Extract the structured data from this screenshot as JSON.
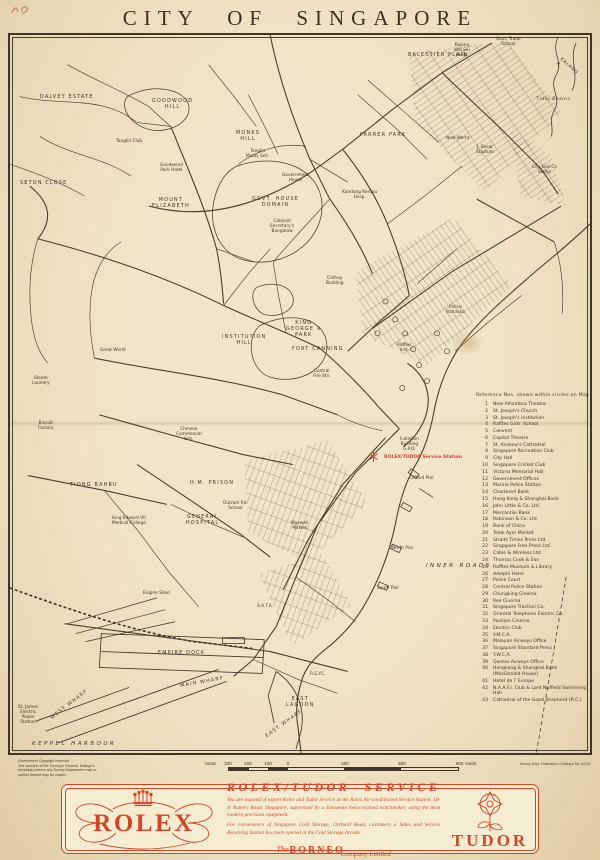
{
  "colors": {
    "accent": "#d64427",
    "ink": "#3f3526",
    "paper": "#e9dcba",
    "ad_bg": "#f5edd2"
  },
  "page": {
    "title": "CITY OF SINGAPORE"
  },
  "map": {
    "service_station_label": "ROLEX/TUDOR Service Station",
    "labels": [
      {
        "t": "DALVEY ESTATE",
        "x": 30,
        "y": 60,
        "cls": "area"
      },
      {
        "t": "GOODWOOD\nHILL",
        "x": 142,
        "y": 64,
        "cls": "area"
      },
      {
        "t": "Tanglin Club",
        "x": 106,
        "y": 104,
        "cls": "place"
      },
      {
        "t": "Goodwood\nPark Hotel",
        "x": 150,
        "y": 128,
        "cls": "place"
      },
      {
        "t": "SETON CLOSE",
        "x": 10,
        "y": 146,
        "cls": "area"
      },
      {
        "t": "MOUNT\nELIZABETH",
        "x": 142,
        "y": 163,
        "cls": "area"
      },
      {
        "t": "MONKS\nHILL",
        "x": 226,
        "y": 96,
        "cls": "area"
      },
      {
        "t": "Tanglin\nMalay Sch.",
        "x": 236,
        "y": 114,
        "cls": "place"
      },
      {
        "t": "FARRER PARK",
        "x": 350,
        "y": 98,
        "cls": "area"
      },
      {
        "t": "Government\nHouse",
        "x": 272,
        "y": 138,
        "cls": "place"
      },
      {
        "t": "GOVT. HOUSE\nDOMAIN",
        "x": 242,
        "y": 162,
        "cls": "area"
      },
      {
        "t": "Kandang Kerbau\nHosp.",
        "x": 332,
        "y": 155,
        "cls": "place"
      },
      {
        "t": "Colonial\nSecretary's\nBungalow",
        "x": 260,
        "y": 184,
        "cls": "place"
      },
      {
        "t": "BALESTIER PLAIN",
        "x": 398,
        "y": 18,
        "cls": "area"
      },
      {
        "t": "Kwong\nWai Siu\nHosp.",
        "x": 444,
        "y": 8,
        "cls": "place"
      },
      {
        "t": "Govt. Trade\nSchool",
        "x": 486,
        "y": 2,
        "cls": "place"
      },
      {
        "t": "Tidal Basins",
        "x": 526,
        "y": 62,
        "cls": "water-i"
      },
      {
        "t": "KALANG R.",
        "x": 552,
        "y": 22,
        "cls": "water-i",
        "rot": 42
      },
      {
        "t": "New World",
        "x": 436,
        "y": 101,
        "cls": "place"
      },
      {
        "t": "J. Besar\nStadium",
        "x": 466,
        "y": 110,
        "cls": "place"
      },
      {
        "t": "City Gas Co\nWorks",
        "x": 522,
        "y": 130,
        "cls": "place"
      },
      {
        "t": "KING\nGEORGE V\nPARK",
        "x": 276,
        "y": 286,
        "cls": "area"
      },
      {
        "t": "FORT  CANNING",
        "x": 282,
        "y": 312,
        "cls": "area"
      },
      {
        "t": "INSTITUTION\nHILL",
        "x": 212,
        "y": 300,
        "cls": "area"
      },
      {
        "t": "Great World",
        "x": 90,
        "y": 313,
        "cls": "place"
      },
      {
        "t": "Steam\nLaundry",
        "x": 22,
        "y": 341,
        "cls": "place"
      },
      {
        "t": "Biscuit\nFactory",
        "x": 28,
        "y": 386,
        "cls": "place"
      },
      {
        "t": "TIONG  BAHRU",
        "x": 60,
        "y": 448,
        "cls": "area"
      },
      {
        "t": "H.M. PRISON",
        "x": 180,
        "y": 446,
        "cls": "area"
      },
      {
        "t": "Chinese\nCommercial\nSch.",
        "x": 166,
        "y": 392,
        "cls": "place"
      },
      {
        "t": "Central\nFire Stn.",
        "x": 303,
        "y": 334,
        "cls": "place"
      },
      {
        "t": "Cathay\nBuilding",
        "x": 316,
        "y": 241,
        "cls": "place"
      },
      {
        "t": "Raffles\nInst.",
        "x": 387,
        "y": 308,
        "cls": "place"
      },
      {
        "t": "Police\nBarracks",
        "x": 436,
        "y": 270,
        "cls": "place"
      },
      {
        "t": "Fullerton\nBuilding\nG.P.O.",
        "x": 390,
        "y": 402,
        "cls": "place"
      },
      {
        "t": "Clifford Pier",
        "x": 399,
        "y": 441,
        "cls": "place"
      },
      {
        "t": "North Pier",
        "x": 382,
        "y": 511,
        "cls": "place"
      },
      {
        "t": "South Pier",
        "x": 367,
        "y": 551,
        "cls": "place"
      },
      {
        "t": "INNER  ROADS",
        "x": 416,
        "y": 528,
        "cls": "water"
      },
      {
        "t": "King Edward VII\nMedical College",
        "x": 102,
        "y": 481,
        "cls": "place"
      },
      {
        "t": "GENERAL\nHOSPITAL",
        "x": 176,
        "y": 480,
        "cls": "area"
      },
      {
        "t": "Outram Rd.\nSchool",
        "x": 213,
        "y": 466,
        "cls": "place"
      },
      {
        "t": "Maxwell\nMarket",
        "x": 281,
        "y": 486,
        "cls": "place"
      },
      {
        "t": "Engine Shed",
        "x": 133,
        "y": 556,
        "cls": "place"
      },
      {
        "t": "S.A.T.A.",
        "x": 247,
        "y": 569,
        "cls": "place"
      },
      {
        "t": "EMPIRE  DOCK",
        "x": 148,
        "y": 616,
        "cls": "area"
      },
      {
        "t": "MAIN  WHARF",
        "x": 170,
        "y": 649,
        "cls": "area",
        "rot": -10
      },
      {
        "t": "WEST  WHARF",
        "x": 40,
        "y": 682,
        "cls": "area",
        "rot": -38
      },
      {
        "t": "EAST  WHARF",
        "x": 255,
        "y": 700,
        "cls": "area",
        "rot": -36
      },
      {
        "t": "EAST\nLAGOON",
        "x": 276,
        "y": 662,
        "cls": "area"
      },
      {
        "t": "St. James\nElectric\nPower\nStation",
        "x": 8,
        "y": 670,
        "cls": "place"
      },
      {
        "t": "R.S.Y.C.",
        "x": 300,
        "y": 637,
        "cls": "place"
      },
      {
        "t": "KEPPEL  HARBOUR",
        "x": 22,
        "y": 706,
        "cls": "water"
      }
    ],
    "reference": {
      "header": "Reference Nos. shown within circles on Map",
      "items": [
        {
          "n": "1",
          "t": "New Alhambra Theatre"
        },
        {
          "n": "2",
          "t": "St. Joseph's Church"
        },
        {
          "n": "3",
          "t": "St. Joseph's Institution"
        },
        {
          "n": "4",
          "t": "Raffles Girls' School"
        },
        {
          "n": "5",
          "t": "Convent"
        },
        {
          "n": "6",
          "t": "Capitol Theatre"
        },
        {
          "n": "7",
          "t": "St. Andrew's Cathedral"
        },
        {
          "n": "8",
          "t": "Singapore Recreation Club"
        },
        {
          "n": "9",
          "t": "City Hall"
        },
        {
          "n": "10",
          "t": "Singapore Cricket Club"
        },
        {
          "n": "11",
          "t": "Victoria Memorial Hall"
        },
        {
          "n": "12",
          "t": "Government Offices"
        },
        {
          "n": "13",
          "t": "Marine Police Station"
        },
        {
          "n": "14",
          "t": "Chartered Bank"
        },
        {
          "n": "15",
          "t": "Hong Kong & Shanghai Bank"
        },
        {
          "n": "16",
          "t": "John Little & Co. Ltd."
        },
        {
          "n": "17",
          "t": "Mercantile Bank"
        },
        {
          "n": "18",
          "t": "Robinson & Co. Ltd."
        },
        {
          "n": "19",
          "t": "Bank of China"
        },
        {
          "n": "20",
          "t": "Telok Ayer Market"
        },
        {
          "n": "21",
          "t": "Straits Times Press Ltd."
        },
        {
          "n": "22",
          "t": "Singapore Free Press Ltd."
        },
        {
          "n": "23",
          "t": "Cable & Wireless Ltd."
        },
        {
          "n": "24",
          "t": "Thomas Cook & Son"
        },
        {
          "n": "25",
          "t": "Raffles Museum & Library"
        },
        {
          "n": "26",
          "t": "Adelphi Hotel"
        },
        {
          "n": "27",
          "t": "Police Court"
        },
        {
          "n": "28",
          "t": "Central Police Station"
        },
        {
          "n": "29",
          "t": "Chungking Cinema"
        },
        {
          "n": "30",
          "t": "Rex Cinema"
        },
        {
          "n": "31",
          "t": "Singapore Traction Co."
        },
        {
          "n": "32",
          "t": "Oriental Telephone Electric Co."
        },
        {
          "n": "33",
          "t": "Pavilion Cinema"
        },
        {
          "n": "34",
          "t": "Electric Club"
        },
        {
          "n": "35",
          "t": "Y.M.C.A."
        },
        {
          "n": "36",
          "t": "Malayan Airways Office"
        },
        {
          "n": "37",
          "t": "Singapore Standard Press"
        },
        {
          "n": "38",
          "t": "Y.W.C.A."
        },
        {
          "n": "39",
          "t": "Qantas Airways Office"
        },
        {
          "n": "40",
          "t": "Hongkong & Shanghai Bank\n(MacDonald House)"
        },
        {
          "n": "41",
          "t": "Hotel de l' Europe"
        },
        {
          "n": "42",
          "t": "N.A.A.F.I. Club & Lord Nuffield Swimming\nHall"
        },
        {
          "n": "43",
          "t": "Cathedral of the Good Shepherd (R.C.)"
        }
      ]
    }
  },
  "footer": {
    "copyright": "Government Copyright reserved.\nThe sanction of the Surveyor General, Malaya is\nnecessary before any Survey Department map or\nportion thereof may be copied.",
    "credit": "Survey Dept. Federation of Malaya No. 54.53",
    "scale": {
      "labels": [
        {
          "t": "Yards",
          "x": -18
        },
        {
          "t": "300",
          "x": 0
        },
        {
          "t": "200",
          "x": 20
        },
        {
          "t": "100",
          "x": 40
        },
        {
          "t": "0",
          "x": 60
        },
        {
          "t": "300",
          "x": 117
        },
        {
          "t": "600",
          "x": 174
        },
        {
          "t": "900 Yards",
          "x": 238
        }
      ]
    }
  },
  "ad": {
    "rolex_wordmark": "ROLEX",
    "tudor_wordmark": "TUDOR",
    "heading": "ROLEX/TUDOR SERVICE",
    "para1": "You are assured of expert Rolex and Tudor Service at the Rolex Air-conditioned Service Station, 18-H Battery Road, Singapore, supervised by a European Swiss-trained watchmaker, using the most modern precision equipment.",
    "para2": "For convenience of Singapore Cold Storage, Orchard Road, customers a Sales and Service Receiving Station has been opened in the Cold Storage Arcade.",
    "company_the": "The",
    "company_name": "BORNEO",
    "company_suffix": "Company Limited"
  }
}
